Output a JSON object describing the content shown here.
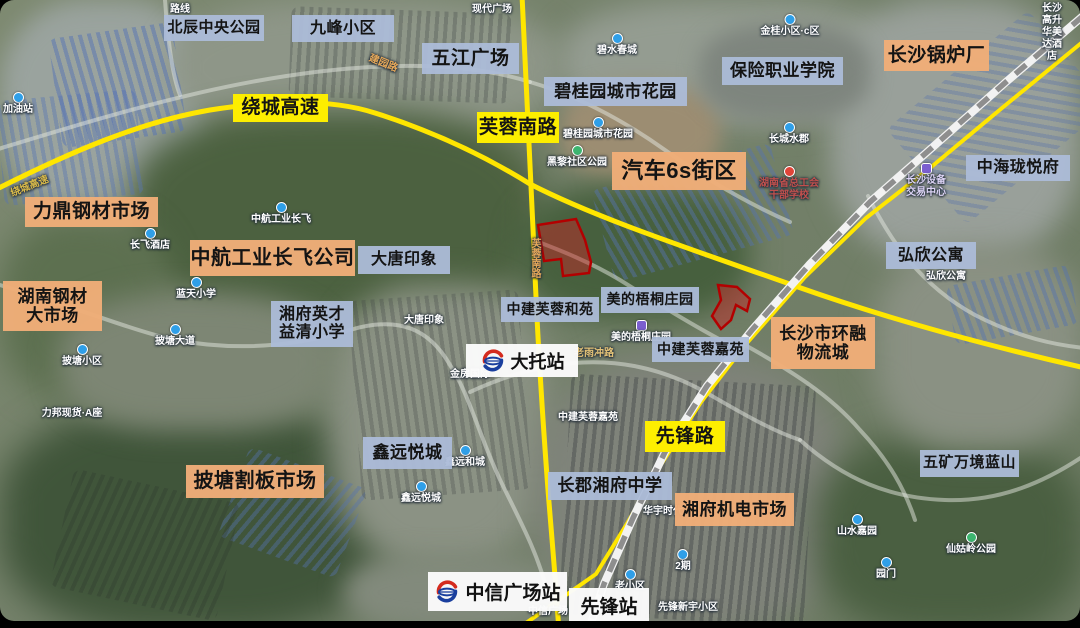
{
  "map": {
    "colors": {
      "label_blue": "#acbcd8",
      "label_orange": "#f0ad78",
      "label_yellow": "#fdee00",
      "road_yellow": "#ffe600",
      "railway_gray": "#8e8e8e",
      "plot_red": "#b30000",
      "poi_blue": "#2f9fe8",
      "poi_green": "#3db56f",
      "poi_purple": "#7b5fd0",
      "poi_red": "#e04438"
    },
    "overlay_labels": [
      {
        "text": "北辰中央公园",
        "x": 164,
        "y": 15,
        "w": 100,
        "h": 26,
        "style": "blue",
        "fs": 15
      },
      {
        "text": "九峰小区",
        "x": 292,
        "y": 15,
        "w": 102,
        "h": 27,
        "style": "blue",
        "fs": 16
      },
      {
        "text": "五江广场",
        "x": 422,
        "y": 43,
        "w": 97,
        "h": 31,
        "style": "blue",
        "fs": 19
      },
      {
        "text": "碧桂园城市花园",
        "x": 544,
        "y": 77,
        "w": 143,
        "h": 29,
        "style": "blue",
        "fs": 17
      },
      {
        "text": "保险职业学院",
        "x": 722,
        "y": 57,
        "w": 121,
        "h": 28,
        "style": "blue",
        "fs": 17
      },
      {
        "text": "长沙锅炉厂",
        "x": 884,
        "y": 40,
        "w": 105,
        "h": 31,
        "style": "orange",
        "fs": 19
      },
      {
        "text": "中海珑悦府",
        "x": 966,
        "y": 155,
        "w": 104,
        "h": 26,
        "style": "blue",
        "fs": 16
      },
      {
        "text": "弘欣公寓",
        "x": 886,
        "y": 242,
        "w": 90,
        "h": 27,
        "style": "blue",
        "fs": 16
      },
      {
        "text": "汽车6s街区",
        "x": 612,
        "y": 152,
        "w": 134,
        "h": 38,
        "style": "orange",
        "fs": 22
      },
      {
        "text": "绕城高速",
        "x": 233,
        "y": 94,
        "w": 95,
        "h": 28,
        "style": "yellow",
        "fs": 19
      },
      {
        "text": "芙蓉南路",
        "x": 477,
        "y": 112,
        "w": 82,
        "h": 31,
        "style": "yellow",
        "fs": 19
      },
      {
        "text": "先锋路",
        "x": 645,
        "y": 421,
        "w": 80,
        "h": 31,
        "style": "yellow",
        "fs": 19
      },
      {
        "text": "力鼎钢材市场",
        "x": 25,
        "y": 197,
        "w": 133,
        "h": 30,
        "style": "orange",
        "fs": 19
      },
      {
        "text": "湖南钢材\n大市场",
        "x": 3,
        "y": 281,
        "w": 99,
        "h": 50,
        "style": "orange",
        "fs": 17
      },
      {
        "text": "中航工业长飞公司",
        "x": 190,
        "y": 240,
        "w": 165,
        "h": 36,
        "style": "orange",
        "fs": 20
      },
      {
        "text": "大唐印象",
        "x": 358,
        "y": 246,
        "w": 92,
        "h": 28,
        "style": "blue",
        "fs": 16
      },
      {
        "text": "湘府英才\n益清小学",
        "x": 271,
        "y": 301,
        "w": 82,
        "h": 46,
        "style": "blue",
        "fs": 16
      },
      {
        "text": "中建芙蓉和苑",
        "x": 501,
        "y": 297,
        "w": 98,
        "h": 25,
        "style": "blue",
        "fs": 14
      },
      {
        "text": "美的梧桐庄园",
        "x": 601,
        "y": 287,
        "w": 98,
        "h": 26,
        "style": "blue",
        "fs": 14
      },
      {
        "text": "中建芙蓉嘉苑",
        "x": 652,
        "y": 337,
        "w": 97,
        "h": 25,
        "style": "blue",
        "fs": 14
      },
      {
        "text": "长沙市环融\n物流城",
        "x": 771,
        "y": 317,
        "w": 104,
        "h": 52,
        "style": "orange",
        "fs": 17
      },
      {
        "text": "鑫远悦城",
        "x": 363,
        "y": 437,
        "w": 89,
        "h": 32,
        "style": "blue",
        "fs": 17
      },
      {
        "text": "披塘割板市场",
        "x": 186,
        "y": 465,
        "w": 138,
        "h": 33,
        "style": "orange",
        "fs": 20
      },
      {
        "text": "长郡湘府中学",
        "x": 548,
        "y": 472,
        "w": 124,
        "h": 28,
        "style": "blue",
        "fs": 17
      },
      {
        "text": "湘府机电市场",
        "x": 675,
        "y": 493,
        "w": 119,
        "h": 33,
        "style": "orange",
        "fs": 17
      },
      {
        "text": "五矿万境蓝山",
        "x": 920,
        "y": 450,
        "w": 99,
        "h": 27,
        "style": "blue",
        "fs": 15
      }
    ],
    "stations": [
      {
        "name": "大托站",
        "x": 466,
        "y": 344,
        "w": 112,
        "h": 33,
        "fs": 18,
        "logo": true
      },
      {
        "name": "中信广场站",
        "x": 428,
        "y": 572,
        "w": 139,
        "h": 39,
        "fs": 19,
        "logo": true
      },
      {
        "name": "先锋站",
        "x": 569,
        "y": 588,
        "w": 80,
        "h": 34,
        "fs": 19,
        "logo": false
      }
    ],
    "base_labels": [
      {
        "t": "路线",
        "x": 180,
        "y": 4
      },
      {
        "t": "现代广场",
        "x": 492,
        "y": 4
      },
      {
        "t": "长沙高升\n华美达酒店",
        "x": 1052,
        "y": 3
      },
      {
        "t": "金桂小区·c区",
        "x": 790,
        "y": 14,
        "icon": "blue"
      },
      {
        "t": "碧水春城",
        "x": 617,
        "y": 33,
        "icon": "blue"
      },
      {
        "t": "加油站",
        "x": 18,
        "y": 92,
        "icon": "blue"
      },
      {
        "t": "碧桂园城市花园",
        "x": 598,
        "y": 117,
        "icon": "blue"
      },
      {
        "t": "黑黎社区公园",
        "x": 577,
        "y": 145,
        "icon": "green"
      },
      {
        "t": "长城水郡",
        "x": 789,
        "y": 122,
        "icon": "blue"
      },
      {
        "t": "湖南省总工会\n干部学校",
        "x": 789,
        "y": 166,
        "icon": "red",
        "c": "#c0504d"
      },
      {
        "t": "长沙设备\n交易中心",
        "x": 926,
        "y": 163,
        "icon": "purple",
        "c": "#ddd4f5"
      },
      {
        "t": "弘欣公寓",
        "x": 946,
        "y": 271
      },
      {
        "t": "中航工业长飞",
        "x": 281,
        "y": 202,
        "icon": "blue"
      },
      {
        "t": "长飞酒店",
        "x": 150,
        "y": 228,
        "icon": "blue"
      },
      {
        "t": "蓝天小学",
        "x": 196,
        "y": 277,
        "icon": "blue"
      },
      {
        "t": "大唐印象",
        "x": 424,
        "y": 315
      },
      {
        "t": "披塘小区",
        "x": 82,
        "y": 344,
        "icon": "blue"
      },
      {
        "t": "披塘大道",
        "x": 175,
        "y": 324,
        "icon": "blue"
      },
      {
        "t": "力邦现货·A座",
        "x": 72,
        "y": 408
      },
      {
        "t": "金房国际",
        "x": 470,
        "y": 369
      },
      {
        "t": "老雨冲路",
        "x": 594,
        "y": 348,
        "c": "#e5c478"
      },
      {
        "t": "中建芙蓉嘉苑",
        "x": 588,
        "y": 412
      },
      {
        "t": "鑫远和城",
        "x": 465,
        "y": 445,
        "icon": "blue"
      },
      {
        "t": "鑫远悦城",
        "x": 421,
        "y": 481,
        "icon": "blue"
      },
      {
        "t": "美的梧桐庄园",
        "x": 641,
        "y": 320,
        "icon": "purple"
      },
      {
        "t": "华宇时代",
        "x": 663,
        "y": 506
      },
      {
        "t": "2期",
        "x": 683,
        "y": 549,
        "icon": "blue"
      },
      {
        "t": "老小区",
        "x": 630,
        "y": 569,
        "icon": "blue"
      },
      {
        "t": "先锋新宇小区",
        "x": 688,
        "y": 602
      },
      {
        "t": "山水嘉园",
        "x": 857,
        "y": 514,
        "icon": "blue"
      },
      {
        "t": "仙姑岭公园",
        "x": 971,
        "y": 532,
        "icon": "green"
      },
      {
        "t": "园门",
        "x": 886,
        "y": 557,
        "icon": "blue"
      },
      {
        "t": "中信广场",
        "x": 548,
        "y": 606
      },
      {
        "t": "绕城高速",
        "x": 30,
        "y": 181,
        "c": "#d8b94a",
        "rot": -22
      },
      {
        "t": "建园路",
        "x": 383,
        "y": 58,
        "c": "#e5a85a",
        "rot": 22
      },
      {
        "t": "芙蓉南路",
        "x": 528,
        "y": 238,
        "c": "#e5a85a",
        "vert": true
      }
    ],
    "highlight_plots": [
      {
        "points": "538,225 576,219 585,240 591,262 589,273 563,276 561,259 544,261"
      },
      {
        "points": "718,285 737,287 750,299 747,311 736,305 731,320 721,329 712,316 721,300"
      }
    ]
  }
}
